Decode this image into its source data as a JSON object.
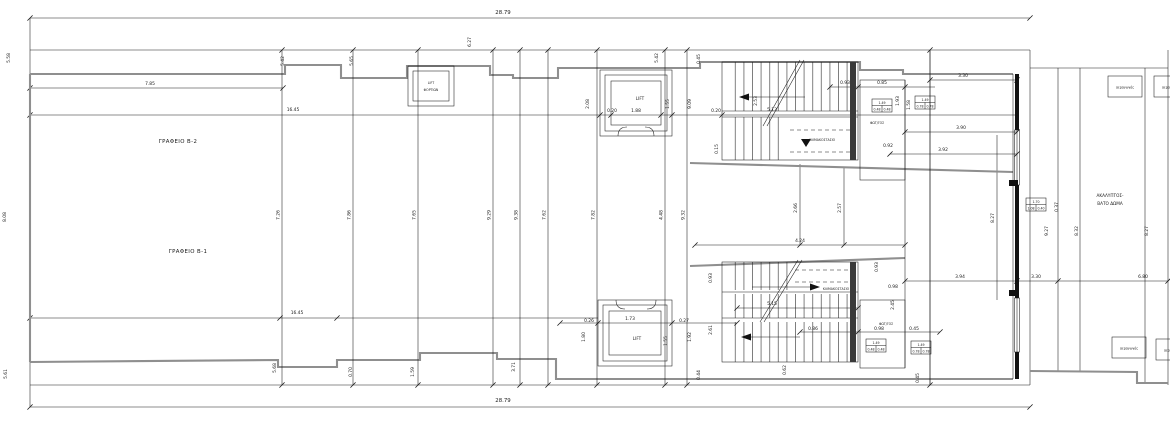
{
  "plan": {
    "colors": {
      "line": "#1a1a1a",
      "outline": "#8f8f8f",
      "background": "#ffffff",
      "stair_core": "#3a3a3a"
    },
    "labels": {
      "office_b2": "ΓΡΑΦΕΙΟ Β-2",
      "office_b1": "ΓΡΑΦΕΙΟ Β-1",
      "lift": "LIFT",
      "freight_lift_line1": "LIFT",
      "freight_lift_line2": "ΦΟΡΤΙΩΝ",
      "staircase": "ΚΛΙΜΑΚΟΣΤΑΣΙΟ",
      "lightwell": "ΦΩΤ/ΓΟΣ",
      "roof_line1": "ΑΚΑΛΥΠΤΟΣ-",
      "roof_line2": "ΒΑΤΟ ΔΩΜΑ",
      "air_duct": "αεραγωγός"
    },
    "overall": {
      "width_top": "28.79",
      "width_bottom": "28.79"
    },
    "grid_lines": [
      {
        "x": 282,
        "label": "7.26"
      },
      {
        "x": 353,
        "label": "7.86"
      },
      {
        "x": 418,
        "label": "7.65"
      },
      {
        "x": 493,
        "label": "9.29"
      },
      {
        "x": 520,
        "label": "9.38"
      },
      {
        "x": 548,
        "label": "7.62"
      },
      {
        "x": 597,
        "label": "7.82"
      },
      {
        "x": 665,
        "label": "4.48"
      },
      {
        "x": 687,
        "label": "9.32"
      },
      {
        "x": 930,
        "label": ""
      }
    ],
    "dim_labels": [
      {
        "x": 503,
        "y": 14,
        "t": "28.79",
        "big": true
      },
      {
        "x": 503,
        "y": 402,
        "t": "28.79",
        "big": true
      },
      {
        "x": 150,
        "y": 85,
        "t": "7.85"
      },
      {
        "x": 293,
        "y": 111,
        "t": "16.45"
      },
      {
        "x": 297,
        "y": 314,
        "t": "16.45"
      },
      {
        "x": 10,
        "y": 58,
        "t": "5.58",
        "r": true
      },
      {
        "x": 284,
        "y": 61,
        "t": "5.42",
        "r": true
      },
      {
        "x": 353,
        "y": 61,
        "t": "5.65",
        "r": true
      },
      {
        "x": 471,
        "y": 42,
        "t": "6.27",
        "r": true
      },
      {
        "x": 658,
        "y": 58,
        "t": "5.42",
        "r": true
      },
      {
        "x": 700,
        "y": 59,
        "t": "0.45",
        "r": true
      },
      {
        "x": 6,
        "y": 217,
        "t": "8.08",
        "r": true
      },
      {
        "x": 612,
        "y": 112,
        "t": "0.20"
      },
      {
        "x": 636,
        "y": 112,
        "t": "1.88"
      },
      {
        "x": 716,
        "y": 112,
        "t": "0.20"
      },
      {
        "x": 757,
        "y": 101,
        "t": "2.53",
        "r": true
      },
      {
        "x": 772,
        "y": 111,
        "t": "5.13"
      },
      {
        "x": 589,
        "y": 104,
        "t": "2.08",
        "r": true
      },
      {
        "x": 669,
        "y": 104,
        "t": "1.55",
        "r": true
      },
      {
        "x": 691,
        "y": 104,
        "t": "9.09",
        "r": true
      },
      {
        "x": 718,
        "y": 149,
        "t": "0.15",
        "r": true
      },
      {
        "x": 845,
        "y": 84,
        "t": "0.93"
      },
      {
        "x": 882,
        "y": 84,
        "t": "0.85"
      },
      {
        "x": 899,
        "y": 101,
        "t": "1.93",
        "r": true
      },
      {
        "x": 910,
        "y": 105,
        "t": "1.58",
        "r": true
      },
      {
        "x": 888,
        "y": 147,
        "t": "0.92"
      },
      {
        "x": 963,
        "y": 77,
        "t": "3.30"
      },
      {
        "x": 961,
        "y": 129,
        "t": "3.90"
      },
      {
        "x": 943,
        "y": 151,
        "t": "3.92"
      },
      {
        "x": 797,
        "y": 208,
        "t": "2.66",
        "r": true
      },
      {
        "x": 841,
        "y": 208,
        "t": "2.57",
        "r": true
      },
      {
        "x": 800,
        "y": 242,
        "t": "4.24"
      },
      {
        "x": 994,
        "y": 218,
        "t": "8.27",
        "r": true
      },
      {
        "x": 772,
        "y": 305,
        "t": "5.15"
      },
      {
        "x": 630,
        "y": 320,
        "t": "1.73"
      },
      {
        "x": 589,
        "y": 322,
        "t": "0.26"
      },
      {
        "x": 684,
        "y": 322,
        "t": "0.27"
      },
      {
        "x": 585,
        "y": 337,
        "t": "1.80",
        "r": true
      },
      {
        "x": 667,
        "y": 341,
        "t": "1.55",
        "r": true
      },
      {
        "x": 691,
        "y": 337,
        "t": "1.92",
        "r": true
      },
      {
        "x": 712,
        "y": 330,
        "t": "2.61",
        "r": true
      },
      {
        "x": 700,
        "y": 375,
        "t": "0.44",
        "r": true
      },
      {
        "x": 712,
        "y": 278,
        "t": "0.93",
        "r": true
      },
      {
        "x": 878,
        "y": 267,
        "t": "0.93",
        "r": true
      },
      {
        "x": 893,
        "y": 288,
        "t": "0.98"
      },
      {
        "x": 960,
        "y": 278,
        "t": "3.94"
      },
      {
        "x": 1036,
        "y": 278,
        "t": "3.30"
      },
      {
        "x": 1143,
        "y": 278,
        "t": "6.80"
      },
      {
        "x": 813,
        "y": 330,
        "t": "0.86"
      },
      {
        "x": 879,
        "y": 330,
        "t": "0.98"
      },
      {
        "x": 914,
        "y": 330,
        "t": "0.45"
      },
      {
        "x": 894,
        "y": 305,
        "t": "2.45",
        "r": true
      },
      {
        "x": 786,
        "y": 370,
        "t": "0.62",
        "r": true
      },
      {
        "x": 919,
        "y": 378,
        "t": "0.45",
        "r": true
      },
      {
        "x": 7,
        "y": 374,
        "t": "5.61",
        "r": true
      },
      {
        "x": 276,
        "y": 368,
        "t": "5.68",
        "r": true
      },
      {
        "x": 352,
        "y": 372,
        "t": "0.70",
        "r": true
      },
      {
        "x": 414,
        "y": 372,
        "t": "1.59",
        "r": true
      },
      {
        "x": 515,
        "y": 367,
        "t": "3.71",
        "r": true
      },
      {
        "x": 1058,
        "y": 207,
        "t": "0.37",
        "r": true
      },
      {
        "x": 1048,
        "y": 231,
        "t": "9.27",
        "r": true
      },
      {
        "x": 1078,
        "y": 231,
        "t": "8.32",
        "r": true
      },
      {
        "x": 1148,
        "y": 231,
        "t": "8.27",
        "r": true
      }
    ],
    "window_tags": [
      {
        "x": 872,
        "y": 99,
        "top": "1.49",
        "a": "0.48",
        "b": "0.48"
      },
      {
        "x": 915,
        "y": 96,
        "top": "1.49",
        "a": "0.78",
        "b": "0.78"
      },
      {
        "x": 866,
        "y": 339,
        "top": "1.49",
        "a": "0.48",
        "b": "0.48"
      },
      {
        "x": 911,
        "y": 341,
        "top": "1.49",
        "a": "0.78",
        "b": "0.78"
      },
      {
        "x": 1026,
        "y": 198,
        "top": "1.70",
        "a": "1.08",
        "b": "0.40"
      }
    ],
    "air_ducts": [
      {
        "x": 1108,
        "y": 76
      },
      {
        "x": 1154,
        "y": 76
      },
      {
        "x": 1112,
        "y": 337
      },
      {
        "x": 1156,
        "y": 339
      }
    ]
  }
}
